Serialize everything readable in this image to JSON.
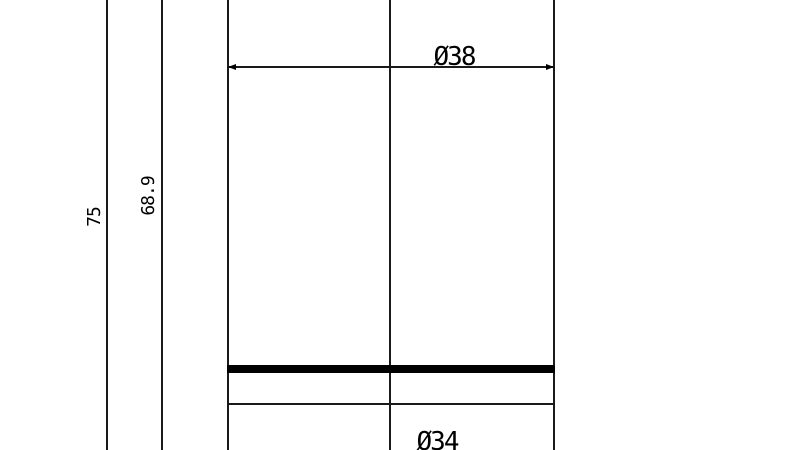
{
  "drawing": {
    "labels": {
      "dia_top": "Ø38",
      "dia_bottom": "Ø34",
      "overall_length": "75",
      "sub_length": "68.9"
    },
    "colors": {
      "line": "#1a1a1a",
      "thick_line": "#000000",
      "background": "#ffffff"
    }
  }
}
